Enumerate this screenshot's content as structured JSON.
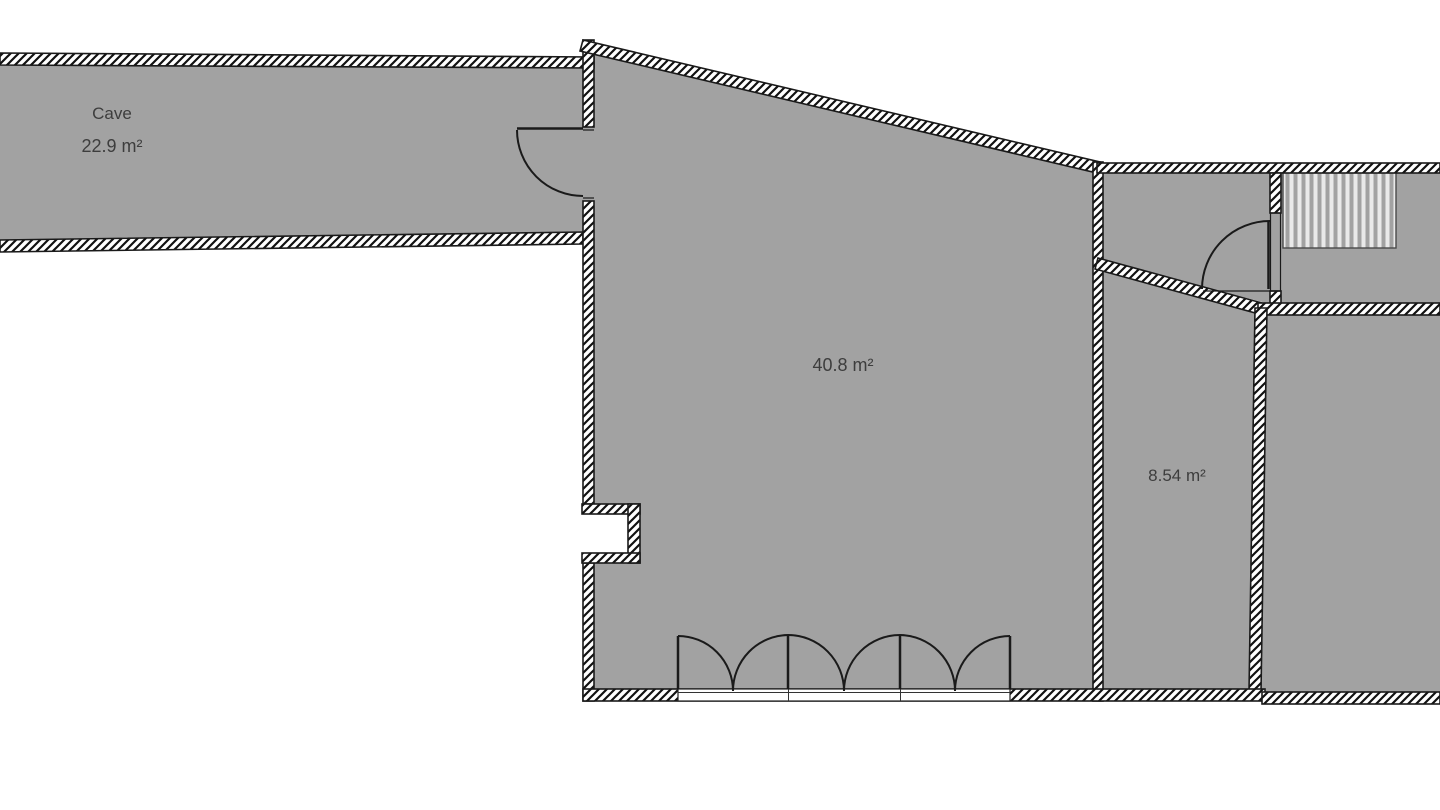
{
  "floorplan": {
    "type": "floor-plan-drawing",
    "rooms": {
      "cave": {
        "name": "Cave",
        "area": "22.9 m²"
      },
      "main": {
        "area": "40.8 m²"
      },
      "small": {
        "area": "8.54 m²"
      }
    },
    "colors": {
      "room_fill": "#a2a2a2",
      "wall_outline": "#1a1a1a",
      "background": "#ffffff",
      "label_text": "#3d3d3d",
      "stair_stripe": "#e9e9e9"
    }
  }
}
